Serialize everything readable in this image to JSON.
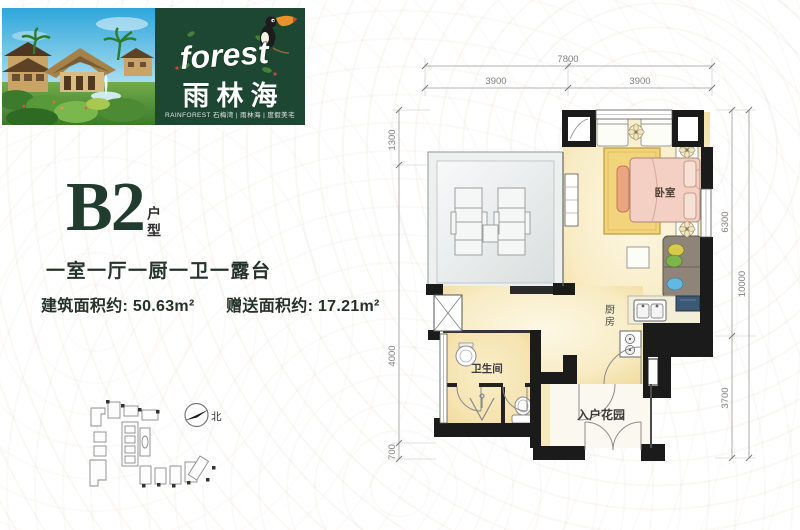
{
  "brand": {
    "logo_en": "forest",
    "logo_cn": "雨林海",
    "tagline": "RAINFOREST  石梅湾 | 雨林海 | 度假美宅",
    "panel_color": "#1d4732"
  },
  "unit": {
    "code": "B2",
    "type_label": "户型",
    "layout": "一室一厅一厨一卫一露台",
    "built_area_label": "建筑面积约:",
    "built_area_value": "50.63m²",
    "bonus_area_label": "赠送面积约:",
    "bonus_area_value": "17.21m²"
  },
  "compass": {
    "north_label": "北"
  },
  "floorplan": {
    "rooms": {
      "bedroom": "卧室",
      "kitchen_char1": "厨",
      "kitchen_char2": "房",
      "bathroom": "卫生间",
      "entry_garden": "入户花园"
    },
    "dimensions": {
      "top_total": "7800",
      "top_left": "3900",
      "top_right": "3900",
      "left_top": "1300",
      "left_mid": "4000",
      "left_bottom": "700",
      "right_upper": "6300",
      "right_lower": "3700",
      "right_total": "10000"
    },
    "colors": {
      "wall": "#1b1b1b",
      "floor_warm": "#f6e4ad",
      "terrace": "#e9edec",
      "bed": "#f3d0c3",
      "rug": "#f1d47c"
    }
  }
}
